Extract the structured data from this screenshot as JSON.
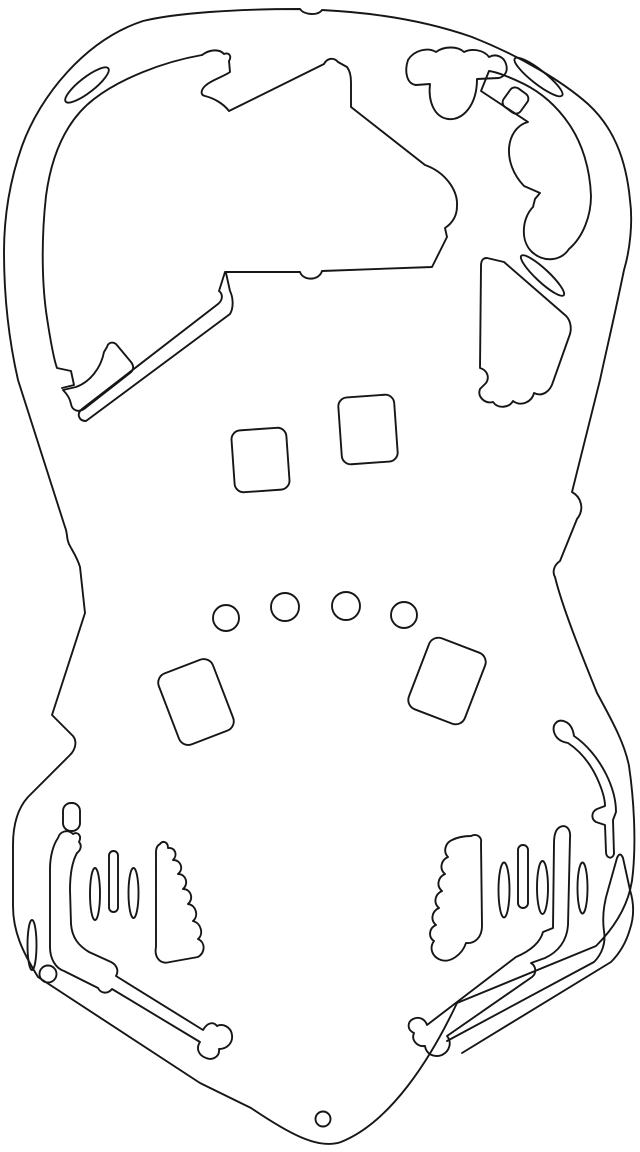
{
  "canvas": {
    "width": 640,
    "height": 1152,
    "background_color": "#ffffff",
    "stroke_color": "#161616",
    "stroke_width": 1.9
  },
  "drawing": {
    "shapes": [
      {
        "name": "outer-boundary",
        "type": "path",
        "d": "M 143 21 C 176 13 235 9 300 9 C 304 15 318 16 322 10 C 382 13 432 23 472 37 C 520 56 562 81 588 104 C 613 127 626 158 630 200 C 633 222 630 250 624 270 C 615 314 606 352 600 380 L 572 492 C 581 497 585 509 577 519 L 560 561 C 554 565 552 572 555 577 C 562 606 580 651 597 693 C 614 724 625 745 629 766 C 634 800 636 840 633 872 C 631 901 616 926 596 946 L 457 1003 C 431 1058 391 1122 341 1142 C 318 1150 288 1133 251 1108 L 200 1083 L 38 977 C 22 951 13 931 13 906 L 13 845 C 13 825 18 808 28 797 L 70 755 C 76 749 77 741 73 736 L 52 715 L 85 613 L 80 567 C 77 557 72 550 70 546 C 66 540 68 534 65 527 L 18 380 C 10 345 4 300 4 252 C 4 215 10 180 22 146 C 40 96 85 40 143 21 Z"
      },
      {
        "name": "arch-inner-rail",
        "type": "path",
        "d": "M 202 55 C 162 62 120 79 94 99 C 68 119 52 151 46 196 C 41 241 42 286 47 318 C 51 344 54 360 57 368 L 71 371 L 74 385 L 62 388"
      },
      {
        "name": "arch-slot-ellipse",
        "type": "ellipse",
        "cx": 87,
        "cy": 85,
        "rx": 27,
        "ry": 7.5,
        "rotate": -38
      },
      {
        "name": "corner-wedge-piece",
        "type": "path",
        "d": "M 63 390 L 76 387 C 90 382 101 368 104 352 L 107 347 C 108 343 112 341 116 344 L 131 362 C 134 366 134 370 130 373 L 84 409 C 78 413 72 410 71 404 C 70 398 67 394 63 390 Z"
      },
      {
        "name": "main-playfield-cutout",
        "type": "path",
        "d": "M 202 55 C 210 49 220 49 224 54 C 229 52 232 56 229 61 L 230 72 C 223 77 211 80 205 86 C 201 90 200 95 205 96 C 213 98 223 103 229 111 L 324 64 C 327 58 334 57 338 62 L 347 67 C 350 71 351 76 351 82 L 351 107 L 425 165 C 445 172 458 190 457 206 C 457 217 451 224 445 228 L 447 237 L 440 251 L 432 267 L 322 271 C 319 281 303 281 300 272 L 225 272 L 219 291 C 223 294 223 300 218 304 L 82 409 C 76 414 79 421 86 421 L 230 314 C 234 307 233 297 230 291 L 226 273"
      },
      {
        "name": "top-right-cloud-cutout",
        "type": "path",
        "d": "M 408 60 C 414 50 428 47 436 52 C 444 46 458 46 464 52 C 472 48 484 50 489 57 C 496 53 504 57 506 64 C 508 70 506 76 499 78 L 477 79 C 477 106 462 121 448 119 C 434 117 428 101 430 84 L 416 85 C 407 84 404 72 408 60 Z"
      },
      {
        "name": "right-scallop-cutout",
        "type": "path",
        "d": "M 481 91 L 528 122 C 506 128 501 162 524 186 L 540 193 L 535 199 L 533 207 C 522 218 520 241 532 252 C 544 263 561 261 569 249 C 583 237 591 216 591 196 C 590 168 582 143 569 124 C 556 105 540 92 524 84 C 512 78 497 72 489 71 L 481 91 Z"
      },
      {
        "name": "top-right-slot-ellipse",
        "type": "ellipse",
        "cx": 538.5,
        "cy": 77,
        "rx": 30,
        "ry": 7,
        "rotate": 38
      },
      {
        "name": "top-right-small-square",
        "type": "rect",
        "x": 505,
        "y": 89,
        "w": 21,
        "h": 23,
        "rx": 6,
        "rotate": 36
      },
      {
        "name": "mid-right-slot-ellipse",
        "type": "ellipse",
        "cx": 542.5,
        "cy": 275.5,
        "rx": 29,
        "ry": 6.5,
        "rotate": 43
      },
      {
        "name": "right-lumpy-panel-cutout",
        "type": "path",
        "d": "M 487 258 L 504 262 L 565 315 C 570 319 572 327 570 334 L 553 382 C 550 392 542 397 534 393 C 532 402 521 407 513 401 C 509 408 498 409 493 402 C 485 404 477 397 480 389 L 486 383 C 490 377 487 370 480 368 L 481 266 C 481 260 483 258 487 258 Z"
      },
      {
        "name": "insert-rect-left",
        "type": "rect",
        "x": 233,
        "y": 429,
        "w": 55,
        "h": 62,
        "rx": 9,
        "rotate": -4
      },
      {
        "name": "insert-rect-right",
        "type": "rect",
        "x": 340,
        "y": 396,
        "w": 56,
        "h": 67,
        "rx": 9,
        "rotate": -4
      },
      {
        "name": "rollover-hole-1",
        "type": "circle",
        "cx": 226,
        "cy": 618,
        "r": 13
      },
      {
        "name": "rollover-hole-2",
        "type": "circle",
        "cx": 285,
        "cy": 607,
        "r": 14
      },
      {
        "name": "rollover-hole-3",
        "type": "circle",
        "cx": 346,
        "cy": 606,
        "r": 14
      },
      {
        "name": "rollover-hole-4",
        "type": "circle",
        "cx": 404,
        "cy": 615,
        "r": 13
      },
      {
        "name": "insert-rect-lower-left",
        "type": "rect",
        "x": 167,
        "y": 664,
        "w": 58,
        "h": 76,
        "rx": 10,
        "rotate": -21
      },
      {
        "name": "insert-rect-lower-right",
        "type": "rect",
        "x": 417,
        "y": 643,
        "w": 60,
        "h": 76,
        "rx": 10,
        "rotate": 21
      },
      {
        "name": "left-small-slot",
        "type": "rect",
        "x": 63,
        "y": 803,
        "w": 17,
        "h": 28,
        "rx": 8,
        "rotate": 0
      },
      {
        "name": "left-lane-guide-cutout",
        "type": "path",
        "d": "M 58 838 C 60 831 68 829 73 834 C 78 831 82 836 79 842 C 82 845 81 850 77 853 C 72 862 70 876 70 890 L 71 924 C 72 938 79 946 89 952 L 111 962 C 117 965 119 971 116 976 L 203 1030 C 207 1023 213 1021 217 1026 C 223 1023 231 1027 232 1035 C 233 1043 227 1049 219 1049 C 220 1056 213 1061 206 1058 C 198 1055 196 1048 200 1042 L 112 989 C 108 994 101 994 98 988 L 64 971 C 55 968 50 958 50 947 L 50 869 C 50 857 53 845 58 838 Z"
      },
      {
        "name": "left-guide-slot-ellipse-1",
        "type": "ellipse",
        "cx": 95,
        "cy": 894,
        "rx": 5,
        "ry": 26,
        "rotate": 0
      },
      {
        "name": "left-guide-slot-bar",
        "type": "rect",
        "x": 109,
        "y": 851,
        "w": 9,
        "h": 61,
        "rx": 4.5,
        "rotate": 0
      },
      {
        "name": "left-guide-slot-ellipse-2",
        "type": "ellipse",
        "cx": 133.5,
        "cy": 893,
        "rx": 5,
        "ry": 25,
        "rotate": 0
      },
      {
        "name": "left-slingshot-cutout",
        "type": "path",
        "d": "M 160 844 C 163 840 168 842 168 848 C 175 847 178 855 173 860 C 181 860 184 869 178 874 C 186 874 189 884 183 889 C 191 889 194 899 188 904 C 196 905 199 916 193 921 C 201 923 204 934 198 939 C 205 942 206 952 198 957 L 170 962 C 160 965 154 957 156 947 L 156 852 C 156 847 158 845 160 844 Z"
      },
      {
        "name": "left-outer-slot-ellipse",
        "type": "ellipse",
        "cx": 32,
        "cy": 945,
        "rx": 4.5,
        "ry": 25,
        "rotate": 0
      },
      {
        "name": "left-small-hole",
        "type": "circle",
        "cx": 48,
        "cy": 974,
        "r": 8.5
      },
      {
        "name": "right-guide-slot-ellipse-1",
        "type": "ellipse",
        "cx": 504,
        "cy": 890,
        "rx": 5.5,
        "ry": 27.5,
        "rotate": 0
      },
      {
        "name": "right-guide-slot-bar",
        "type": "rect",
        "x": 518,
        "y": 845,
        "w": 10,
        "h": 63,
        "rx": 5,
        "rotate": 0
      },
      {
        "name": "right-guide-slot-ellipse-2",
        "type": "ellipse",
        "cx": 542.5,
        "cy": 887.5,
        "rx": 5.5,
        "ry": 26.5,
        "rotate": 0
      },
      {
        "name": "right-guide-slot-ellipse-3",
        "type": "ellipse",
        "cx": 582.5,
        "cy": 888,
        "rx": 5,
        "ry": 25.5,
        "rotate": 0
      },
      {
        "name": "right-slingshot-cutout",
        "type": "path",
        "d": "M 471 836 C 477 833 482 837 481 843 L 482 926 C 482 937 475 944 466 943 C 462 955 450 963 441 960 C 432 957 429 948 434 941 C 428 937 429 928 436 925 C 430 920 432 911 439 908 C 433 903 435 894 442 891 C 436 886 438 877 445 874 C 439 869 441 860 448 857 C 443 852 445 843 452 840 C 458 837 465 836 471 836 Z"
      },
      {
        "name": "right-lane-guide-cutout",
        "type": "path",
        "d": "M 560 827 C 566 824 571 829 570 838 L 568 925 C 567 941 558 952 545 958 L 531 963 C 536 966 537 973 532 977 L 447 1036 C 452 1042 450 1051 442 1055 C 434 1058 426 1054 425 1046 C 417 1047 411 1040 414 1033 C 407 1030 407 1022 413 1019 C 419 1016 425 1019 427 1025 L 516 957 C 530 951 540 943 543 932 L 553 928 L 554 843 C 554 835 556 829 560 827 Z"
      },
      {
        "name": "right-hook-cutout",
        "type": "path",
        "d": "M 566 722 C 558 718 552 724 554 732 C 556 739 562 742 568 743 C 580 751 590 763 597 778 C 602 789 605 798 605 806 L 597 809 C 591 812 591 819 596 822 L 605 825 L 606 852 C 606 858 612 860 614 854 L 613 820 L 616 812 C 616 798 612 786 606 774 C 598 758 586 744 574 736 C 573 729 570 724 566 722 Z"
      },
      {
        "name": "right-outlane-channel",
        "type": "path",
        "d": "M 447 1041 L 594 962 C 602 954 606 943 604 931 C 602 917 604 903 608 890 L 617 858 Q 620 851 623 858 L 630 890 C 634 903 634 917 630 929 C 626 943 620 953 611 962 L 462 1053"
      },
      {
        "name": "bottom-apron-hole",
        "type": "circle",
        "cx": 323,
        "cy": 1119,
        "r": 7.5
      }
    ]
  }
}
